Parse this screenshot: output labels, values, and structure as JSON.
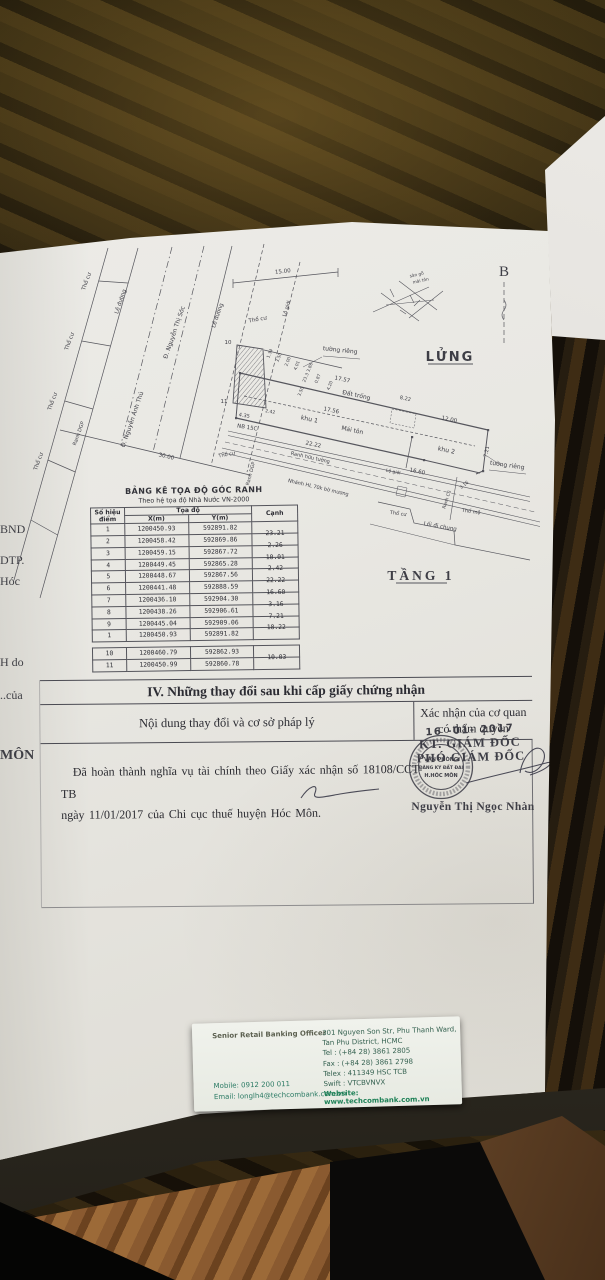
{
  "colors": {
    "paper": "#e9e8e3",
    "stamp_ink": "#3a3a44",
    "card_accent": "#1e8157",
    "wood_base": "#32290f"
  },
  "document": {
    "margin_fragments": {
      "f1": "BND",
      "f2": "DTP.",
      "f3": "Hóc",
      "f4": "H do",
      "f5": "..của",
      "f6": "MÔN"
    },
    "drawing": {
      "labels": {
        "north": "B",
        "lung": "LỬNG",
        "tang1": "TẦNG 1",
        "khu1": "khu 1",
        "khu2": "khu 2",
        "dat_trong": "Đất trống",
        "mai_ton": "Mái tôn",
        "tuong_rieng": "tường riêng",
        "le_duong": "Lề đường",
        "lo_gioi": "Lộ giới",
        "tho_cu": "Thổ cư",
        "tho_mo": "Thổ mộ",
        "ranh_dgp": "Ranh DGP",
        "street1": "Đ. Nguyễn Ánh Thủ",
        "street2": "Đ. Nguyễn Thị Sóc",
        "ranh_huu_tuong": "Ranh hữu tường",
        "nhanh_muong": "Nhánh HL 70k bờ mương",
        "loi_di_chung": "Lối đi chung",
        "ranh_cu": "Ranh Cũ",
        "nb15c": "NB 15C",
        "san_go": "sàn gỗ",
        "san_go2": "mái tôn",
        "point10": "10",
        "point11": "11"
      },
      "dims": {
        "d30": "30.00",
        "d15": "15.00",
        "d1757": "17.57",
        "d1756": "17.56",
        "d822": "8.22",
        "d12": "12.00",
        "d2222": "22.22",
        "d1660": "16.60",
        "d721": "7.21",
        "d316": "3.16",
        "d435": "4.35",
        "d242": "2.42",
        "cluster": [
          "1.34",
          "3.50",
          "2.00",
          "4.01",
          "23.3 3.86",
          "0.87",
          "3.50",
          "4.20"
        ]
      }
    },
    "coord_table": {
      "title": "BẢNG KÊ TỌA ĐỘ GÓC RANH",
      "subtitle": "Theo hệ tọa độ Nhà Nước VN-2000",
      "col_point": "Số hiệu\nđiểm",
      "col_coord": "Tọa độ",
      "col_x": "X(m)",
      "col_y": "Y(m)",
      "col_edge": "Cạnh",
      "rows": [
        {
          "p": "1",
          "x": "1200450.93",
          "y": "592891.82",
          "c": ""
        },
        {
          "p": "2",
          "x": "1200458.42",
          "y": "592869.86",
          "c": "23.21"
        },
        {
          "p": "3",
          "x": "1200459.15",
          "y": "592867.72",
          "c": "2.26"
        },
        {
          "p": "4",
          "x": "1200449.45",
          "y": "592865.28",
          "c": "10.01"
        },
        {
          "p": "5",
          "x": "1200448.67",
          "y": "592867.56",
          "c": "2.42"
        },
        {
          "p": "6",
          "x": "1200441.48",
          "y": "592888.59",
          "c": "22.22"
        },
        {
          "p": "7",
          "x": "1200436.10",
          "y": "592904.30",
          "c": "16.60"
        },
        {
          "p": "8",
          "x": "1200438.26",
          "y": "592906.61",
          "c": "3.16"
        },
        {
          "p": "9",
          "x": "1200445.04",
          "y": "592909.06",
          "c": "7.21"
        },
        {
          "p": "1",
          "x": "1200450.93",
          "y": "592891.82",
          "c": "18.22"
        }
      ],
      "rows2": [
        {
          "p": "10",
          "x": "1200460.79",
          "y": "592862.93",
          "c": ""
        },
        {
          "p": "11",
          "x": "1200450.99",
          "y": "592860.78",
          "c": "10.03"
        }
      ]
    },
    "section4": {
      "title": "IV. Những thay đổi sau khi cấp giấy chứng nhận",
      "col_left": "Nội dung thay đổi và cơ sở pháp lý",
      "col_right_1": "Xác nhận của cơ quan",
      "col_right_2": "có thẩm quyền",
      "body_line1": "Đã hoàn thành nghĩa vụ tài chính theo Giấy xác nhận số 18108/CCT-TB",
      "body_line2": "ngày 11/01/2017 của Chi cục thuế huyện Hóc Môn.",
      "date_stamp": "16 -01- 2017",
      "kt_line": "KT. GIÁM ĐỐC",
      "pho_line": "PHÓ GIÁM ĐỐC",
      "stamp": {
        "l1": "VĂN PHÒNG",
        "l2": "ĐĂNG KÝ ĐẤT ĐAI",
        "l3": "H.HÓC MÔN"
      },
      "signer": "Nguyễn Thị Ngọc Nhàn"
    }
  },
  "business_card": {
    "title": "Senior Retail Banking Officer",
    "mobile": "Mobile: 0912 200 011",
    "email": "Email: longlh4@techcombank.com.vn",
    "addr1": "301 Nguyen Son Str, Phu Thanh Ward,",
    "addr2": "Tan Phu District, HCMC",
    "tel": "Tel : (+84 28) 3861 2805",
    "fax": "Fax : (+84 28) 3861 2798",
    "telex": "Telex : 411349 HSC TCB",
    "swift": "Swift : VTCBVNVX",
    "website": "Website: www.techcombank.com.vn"
  }
}
